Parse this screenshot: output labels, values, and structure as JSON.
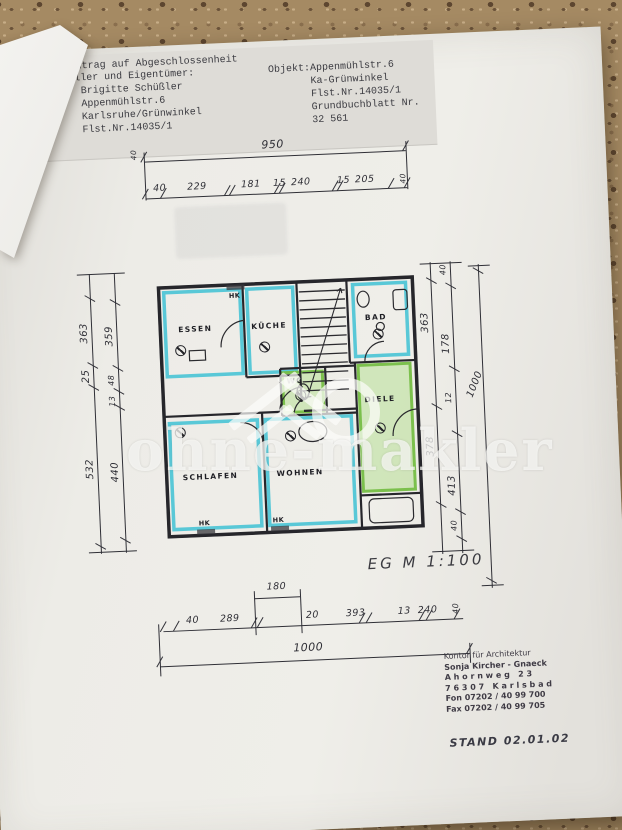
{
  "colors": {
    "cyan": "#48c3d5",
    "green": "#76be46",
    "paper": "#e9e7e2",
    "granite": "#a58a63",
    "ink": "#2f2f36"
  },
  "header": {
    "left": {
      "line1": "Betreff: Antrag auf Abgeschlossenheit",
      "line2": "Antragsteller und Eigentümer:",
      "name": "Brigitte Schüßler",
      "street": "Appenmühlstr.6",
      "city": "Karlsruhe/Grünwinkel",
      "flst": "Flst.Nr.14035/1"
    },
    "right": {
      "objekt": "Objekt:Appenmühlstr.6",
      "district": "Ka-Grünwinkel",
      "flst": "Flst.Nr.14035/1",
      "grundbuch": "Grundbuchblatt Nr.",
      "grundbuch_nr": "32 561"
    }
  },
  "dims": {
    "top": {
      "overall": "950",
      "chain": [
        "40",
        "229",
        "181",
        "15",
        "240",
        "15",
        "205",
        "40"
      ]
    },
    "left": {
      "outer": [
        "363",
        "25",
        "532"
      ],
      "inner": [
        "359",
        "48",
        "13",
        "440"
      ]
    },
    "right": {
      "col_a": [
        "363",
        "378"
      ],
      "col_b": [
        "40",
        "178",
        "12",
        "413",
        "40"
      ],
      "overall": "1000"
    },
    "bottom": {
      "inner": "180",
      "chain": [
        "40",
        "289",
        "20",
        "393",
        "13",
        "240",
        "40"
      ],
      "overall": "1000"
    }
  },
  "plan": {
    "rooms": {
      "essen": "ESSEN",
      "kueche": "KÜCHE",
      "bad": "BAD",
      "wc": "WC",
      "diele": "DIELE",
      "schlafen": "SCHLAFEN",
      "wohnen": "WOHNEN"
    },
    "hk": "HK"
  },
  "notes": {
    "scale": "EG M 1:100",
    "stand": "STAND 02.01.02"
  },
  "stamp": {
    "line1": "Kontor für Architektur",
    "line2": "Sonja Kircher - Gnaeck",
    "line3": "Ahornweg 23",
    "line4": "76307 Karlsbad",
    "line5": "Fon 07202 / 40 99 700",
    "line6": "Fax 07202 / 40 99 705"
  },
  "watermark": {
    "text": "ohne-makler"
  }
}
